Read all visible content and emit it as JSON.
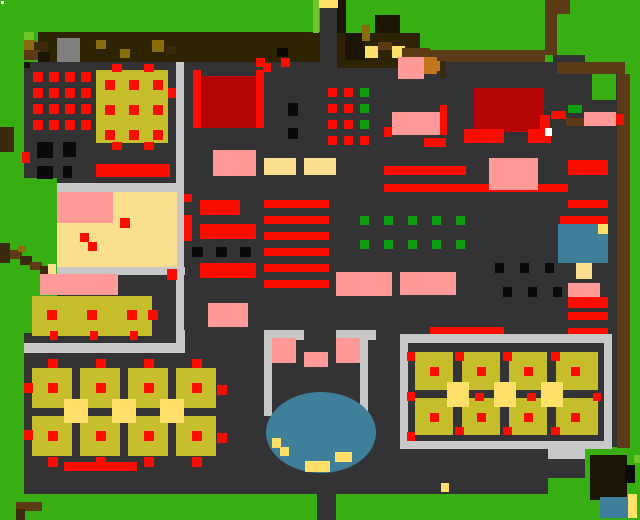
{
  "meta": {
    "view": "pixel-art-village-map",
    "description": "Top-down tile map: grass exterior, dark floor interior, tables, shelves, ponds",
    "width": 640,
    "height": 520
  },
  "palette": {
    "grass": "#37ae11",
    "grassLight": "#6fc32b",
    "floor": "#333336",
    "band": "#2e2302",
    "bandDark": "#1c1404",
    "brown": "#5c3a16",
    "brownDark": "#3c2a0e",
    "orange": "#c4761e",
    "darkYellow": "#8a6d0e",
    "olive": "#c6bd2b",
    "paleYellow": "#fbdf8e",
    "yellow": "#ffe069",
    "pink": "#ff9a98",
    "red": "#fb0d00",
    "darkRed": "#b40404",
    "green": "#0f9e10",
    "black": "#0a0a0a",
    "gray": "#c8c8c8",
    "grayMid": "#7f7f7f",
    "blue": "#3f7f9a",
    "white": "#ffffff"
  },
  "shapes": [
    [
      "r",
      24,
      62,
      593,
      432,
      "floor",
      "main-floor"
    ],
    [
      "r",
      0,
      178,
      57,
      155,
      "grass",
      "grass-notch-left"
    ],
    [
      "r",
      0,
      494,
      640,
      26,
      "grass",
      "grass-bottom"
    ],
    [
      "r",
      583,
      447,
      57,
      47,
      "grass",
      "grass-bottom-right"
    ],
    [
      "r",
      548,
      448,
      37,
      11,
      "gray",
      "wall-stub"
    ],
    [
      "r",
      548,
      459,
      37,
      19,
      "floor",
      "floor-stub"
    ],
    [
      "r",
      548,
      478,
      37,
      16,
      "grass",
      "grass-stub"
    ],
    [
      "r",
      1,
      1,
      3,
      3,
      "white",
      "map-dot"
    ],
    [
      "r",
      38,
      32,
      282,
      30,
      "band",
      "top-band-left"
    ],
    [
      "r",
      337,
      33,
      83,
      35,
      "band",
      "top-band-right"
    ],
    [
      "r",
      337,
      0,
      9,
      33,
      "bandDark",
      "gate-post"
    ],
    [
      "r",
      57,
      38,
      23,
      24,
      "grayMid",
      "band-gray-box"
    ],
    [
      "r",
      96,
      40,
      10,
      9,
      "darkYellow",
      "band-fleck"
    ],
    [
      "r",
      120,
      49,
      10,
      9,
      "darkYellow",
      "band-fleck"
    ],
    [
      "r",
      152,
      40,
      12,
      12,
      "darkYellow",
      "band-fleck"
    ],
    [
      "r",
      166,
      46,
      10,
      8,
      "brownDark",
      "band-fleck"
    ],
    [
      "r",
      277,
      48,
      11,
      9,
      "black",
      "band-fleck"
    ],
    [
      "r",
      345,
      33,
      20,
      27,
      "bandDark",
      "band-shadow"
    ],
    [
      "r",
      362,
      25,
      8,
      16,
      "darkYellow",
      "band-fleck"
    ],
    [
      "r",
      375,
      15,
      25,
      18,
      "bandDark",
      "tree-top"
    ],
    [
      "r",
      378,
      42,
      14,
      8,
      "brown",
      "band-post"
    ],
    [
      "r",
      365,
      46,
      13,
      12,
      "yellow",
      "lantern"
    ],
    [
      "r",
      392,
      46,
      13,
      12,
      "yellow",
      "lantern"
    ],
    [
      "r",
      402,
      48,
      28,
      10,
      "brown",
      "band-rail"
    ],
    [
      "r",
      256,
      58,
      9,
      9,
      "red",
      "gate-marker"
    ],
    [
      "r",
      281,
      58,
      9,
      9,
      "red",
      "gate-marker"
    ],
    [
      "r",
      24,
      32,
      10,
      10,
      "grassLight",
      "bush"
    ],
    [
      "r",
      24,
      40,
      12,
      10,
      "darkYellow",
      "bush"
    ],
    [
      "r",
      34,
      42,
      14,
      12,
      "brownDark",
      "bush"
    ],
    [
      "r",
      24,
      50,
      16,
      10,
      "brown",
      "bush"
    ],
    [
      "r",
      38,
      52,
      12,
      10,
      "bandDark",
      "bush"
    ],
    [
      "r",
      24,
      62,
      6,
      6,
      "bandDark",
      "bush"
    ],
    [
      "r",
      320,
      8,
      17,
      54,
      "floor",
      "north-path"
    ],
    [
      "r",
      318,
      0,
      20,
      8,
      "yellow",
      "north-gate"
    ],
    [
      "r",
      313,
      0,
      6,
      33,
      "grassLight",
      "grass-light-strip"
    ],
    [
      "r",
      420,
      50,
      125,
      12,
      "brown",
      "fence-top"
    ],
    [
      "r",
      420,
      57,
      17,
      17,
      "orange",
      "fence-block"
    ],
    [
      "r",
      545,
      0,
      25,
      14,
      "brown",
      "fence-v"
    ],
    [
      "r",
      545,
      14,
      12,
      41,
      "brown",
      "fence-v"
    ],
    [
      "r",
      553,
      55,
      32,
      43,
      "floor",
      "alcove"
    ],
    [
      "r",
      557,
      62,
      68,
      12,
      "brown",
      "fence-top-2"
    ],
    [
      "r",
      617,
      74,
      13,
      374,
      "brown",
      "right-strip"
    ],
    [
      "r",
      630,
      74,
      10,
      374,
      "grass",
      "grass-right-edge"
    ],
    [
      "r",
      592,
      74,
      24,
      26,
      "grass",
      "grass-pocket"
    ],
    [
      "r",
      473,
      88,
      71,
      44,
      "darkRed",
      "big-red-block"
    ],
    [
      "r",
      464,
      129,
      40,
      14,
      "red",
      "red-trim"
    ],
    [
      "r",
      528,
      129,
      23,
      14,
      "red",
      "red-trim"
    ],
    [
      "r",
      540,
      115,
      10,
      16,
      "red",
      "red-trim"
    ],
    [
      "r",
      440,
      105,
      7,
      30,
      "red",
      "red-trim"
    ],
    [
      "r",
      545,
      128,
      7,
      8,
      "white",
      "white-dot"
    ],
    [
      "r",
      568,
      105,
      14,
      8,
      "green",
      "green-chip"
    ],
    [
      "r",
      551,
      111,
      15,
      8,
      "red",
      "red-chip"
    ],
    [
      "r",
      566,
      118,
      18,
      8,
      "brown",
      "brown-chip"
    ],
    [
      "r",
      584,
      112,
      32,
      14,
      "pink",
      "pink-mat"
    ],
    [
      "r",
      616,
      114,
      8,
      11,
      "red",
      "red-dot"
    ],
    [
      "r",
      398,
      57,
      26,
      22,
      "pink",
      "pink-mat"
    ],
    [
      "r",
      424,
      61,
      16,
      10,
      "orange",
      "crate-orange"
    ],
    [
      "r",
      440,
      61,
      6,
      17,
      "brownDark",
      "crate-shadow"
    ],
    [
      "r",
      392,
      112,
      48,
      23,
      "pink",
      "pink-mat"
    ],
    [
      "r",
      384,
      127,
      8,
      10,
      "red",
      "red-dot"
    ],
    [
      "r",
      424,
      138,
      22,
      9,
      "red",
      "red-trim"
    ],
    [
      "r",
      384,
      166,
      82,
      9,
      "red",
      "shelf-bar"
    ],
    [
      "r",
      384,
      184,
      184,
      8,
      "red",
      "shelf-bar"
    ],
    [
      "r",
      489,
      158,
      49,
      32,
      "pink",
      "pink-mat"
    ],
    [
      "r",
      568,
      160,
      40,
      15,
      "red",
      "shelf-bar"
    ],
    [
      "r",
      568,
      200,
      40,
      8,
      "red",
      "shelf-bar"
    ],
    [
      "r",
      560,
      216,
      48,
      9,
      "red",
      "shelf-bar"
    ],
    [
      "r",
      558,
      224,
      50,
      39,
      "blue",
      "pool"
    ],
    [
      "r",
      598,
      224,
      10,
      10,
      "yellow",
      "pool-duck"
    ],
    [
      "r",
      576,
      263,
      16,
      16,
      "paleYellow",
      "pool-step"
    ],
    [
      "r",
      568,
      283,
      32,
      14,
      "pink",
      "pink-mat"
    ],
    [
      "r",
      568,
      297,
      40,
      11,
      "red",
      "shelf-bar"
    ],
    [
      "r",
      568,
      312,
      40,
      8,
      "red",
      "shelf-bar"
    ],
    [
      "r",
      568,
      328,
      40,
      9,
      "red",
      "shelf-bar"
    ],
    [
      "r",
      553,
      288,
      6,
      8,
      "black",
      "black-chip"
    ],
    [
      "g",
      33,
      72,
      16,
      16,
      4,
      4,
      10,
      10,
      "red",
      "stock-dot"
    ],
    [
      "r",
      96,
      70,
      72,
      73,
      "olive",
      "big-table"
    ],
    [
      "g",
      105,
      80,
      24,
      25,
      3,
      3,
      10,
      10,
      "red",
      "table-dot"
    ],
    [
      "r",
      112,
      64,
      10,
      8,
      "red",
      "table-dot"
    ],
    [
      "r",
      144,
      64,
      10,
      8,
      "red",
      "table-dot"
    ],
    [
      "r",
      112,
      142,
      10,
      8,
      "red",
      "table-dot"
    ],
    [
      "r",
      144,
      142,
      10,
      8,
      "red",
      "table-dot"
    ],
    [
      "r",
      168,
      88,
      10,
      10,
      "red",
      "table-dot"
    ],
    [
      "r",
      176,
      62,
      8,
      281,
      "gray",
      "wall-vertical"
    ],
    [
      "r",
      193,
      70,
      8,
      58,
      "red",
      "banner-post"
    ],
    [
      "r",
      256,
      70,
      8,
      58,
      "red",
      "banner-post"
    ],
    [
      "r",
      201,
      76,
      55,
      52,
      "darkRed",
      "red-banner"
    ],
    [
      "r",
      263,
      63,
      8,
      9,
      "red",
      "red-dot"
    ],
    [
      "r",
      288,
      103,
      10,
      13,
      "black",
      "black-post"
    ],
    [
      "r",
      288,
      128,
      10,
      11,
      "black",
      "black-post"
    ],
    [
      "g",
      328,
      88,
      16,
      16,
      2,
      4,
      9,
      9,
      "red",
      "stock-dot"
    ],
    [
      "g",
      360,
      88,
      0,
      16,
      1,
      3,
      9,
      9,
      "green",
      "stock-dot-green"
    ],
    [
      "r",
      360,
      136,
      9,
      9,
      "red",
      "stock-dot"
    ],
    [
      "r",
      37,
      142,
      16,
      16,
      "black",
      "crate"
    ],
    [
      "r",
      63,
      142,
      13,
      15,
      "black",
      "crate"
    ],
    [
      "r",
      37,
      166,
      16,
      13,
      "black",
      "crate"
    ],
    [
      "r",
      63,
      166,
      9,
      12,
      "black",
      "crate"
    ],
    [
      "r",
      22,
      152,
      8,
      11,
      "red",
      "red-dot"
    ],
    [
      "r",
      96,
      164,
      74,
      13,
      "red",
      "red-bar"
    ],
    [
      "r",
      0,
      127,
      14,
      25,
      "brownDark",
      "stump"
    ],
    [
      "r",
      213,
      150,
      43,
      26,
      "pink",
      "pink-mat"
    ],
    [
      "r",
      264,
      158,
      32,
      17,
      "paleYellow",
      "mat"
    ],
    [
      "r",
      304,
      158,
      32,
      17,
      "paleYellow",
      "mat"
    ],
    [
      "r",
      57,
      183,
      127,
      9,
      "gray",
      "room-wall-top"
    ],
    [
      "r",
      57,
      192,
      56,
      31,
      "pink",
      "room-rug"
    ],
    [
      "r",
      113,
      192,
      64,
      75,
      "paleYellow",
      "room-floor"
    ],
    [
      "r",
      57,
      223,
      56,
      44,
      "paleYellow",
      "room-floor"
    ],
    [
      "r",
      120,
      218,
      10,
      10,
      "red",
      "room-dot"
    ],
    [
      "r",
      80,
      233,
      9,
      9,
      "red",
      "room-dot"
    ],
    [
      "r",
      88,
      242,
      9,
      9,
      "red",
      "room-dot"
    ],
    [
      "r",
      57,
      267,
      128,
      8,
      "gray",
      "room-wall-bottom"
    ],
    [
      "r",
      167,
      269,
      10,
      11,
      "red",
      "door-marker"
    ],
    [
      "r",
      184,
      194,
      8,
      8,
      "red",
      "wall-dot"
    ],
    [
      "r",
      184,
      215,
      8,
      26,
      "red",
      "wall-banner"
    ],
    [
      "g",
      264,
      200,
      0,
      16,
      1,
      6,
      65,
      8,
      "red",
      "shelf-stripe"
    ],
    [
      "r",
      200,
      200,
      40,
      15,
      "red",
      "counter-bar"
    ],
    [
      "r",
      200,
      224,
      56,
      15,
      "red",
      "counter-bar"
    ],
    [
      "r",
      200,
      263,
      56,
      15,
      "red",
      "counter-bar"
    ],
    [
      "g",
      192,
      247,
      24,
      0,
      3,
      1,
      11,
      10,
      "black",
      "black-dot"
    ],
    [
      "g",
      360,
      216,
      24,
      24,
      5,
      2,
      9,
      9,
      "green",
      "plant-dot"
    ],
    [
      "r",
      336,
      272,
      56,
      24,
      "pink",
      "pink-mat"
    ],
    [
      "r",
      400,
      272,
      56,
      23,
      "pink",
      "pink-mat"
    ],
    [
      "r",
      208,
      303,
      40,
      24,
      "pink",
      "pink-mat"
    ],
    [
      "r",
      0,
      243,
      10,
      20,
      "brownDark",
      "log"
    ],
    [
      "r",
      10,
      250,
      12,
      9,
      "brown",
      "log"
    ],
    [
      "r",
      20,
      256,
      12,
      9,
      "brownDark",
      "log"
    ],
    [
      "r",
      30,
      262,
      12,
      8,
      "brown",
      "log"
    ],
    [
      "r",
      40,
      266,
      10,
      8,
      "brownDark",
      "log"
    ],
    [
      "r",
      18,
      246,
      8,
      6,
      "darkYellow",
      "log-moss"
    ],
    [
      "r",
      48,
      264,
      8,
      10,
      "paleYellow",
      "log-end"
    ],
    [
      "r",
      40,
      274,
      78,
      21,
      "pink",
      "pink-bench"
    ],
    [
      "r",
      32,
      296,
      120,
      40,
      "olive",
      "long-table"
    ],
    [
      "g",
      47,
      310,
      40,
      0,
      3,
      1,
      10,
      10,
      "red",
      "table-dot"
    ],
    [
      "r",
      148,
      310,
      10,
      10,
      "red",
      "table-dot"
    ],
    [
      "g",
      50,
      331,
      40,
      0,
      3,
      1,
      8,
      9,
      "red",
      "table-dot"
    ],
    [
      "r",
      24,
      343,
      161,
      10,
      "gray",
      "wall-horizontal"
    ],
    [
      "r",
      177,
      330,
      8,
      13,
      "gray",
      "wall-corner"
    ],
    [
      "g",
      32,
      368,
      48,
      48,
      4,
      2,
      40,
      40,
      "olive",
      "dining-table"
    ],
    [
      "g",
      64,
      399,
      48,
      0,
      3,
      1,
      24,
      24,
      "yellow",
      "chair"
    ],
    [
      "g",
      48,
      383,
      48,
      48,
      4,
      2,
      10,
      10,
      "red",
      "table-dot"
    ],
    [
      "g",
      48,
      359,
      48,
      0,
      4,
      1,
      10,
      9,
      "red",
      "table-dot"
    ],
    [
      "g",
      48,
      457,
      48,
      0,
      4,
      1,
      10,
      10,
      "red",
      "table-dot"
    ],
    [
      "r",
      24,
      383,
      9,
      10,
      "red",
      "table-dot"
    ],
    [
      "r",
      24,
      430,
      9,
      10,
      "red",
      "table-dot"
    ],
    [
      "r",
      217,
      385,
      10,
      10,
      "red",
      "table-dot"
    ],
    [
      "r",
      217,
      433,
      10,
      10,
      "red",
      "table-dot"
    ],
    [
      "r",
      64,
      462,
      73,
      9,
      "red",
      "red-bar"
    ],
    [
      "r",
      16,
      502,
      26,
      9,
      "brown",
      "sign"
    ],
    [
      "r",
      16,
      509,
      9,
      11,
      "brownDark",
      "sign-post"
    ],
    [
      "r",
      264,
      330,
      40,
      10,
      "gray",
      "pond-wall"
    ],
    [
      "r",
      336,
      330,
      40,
      10,
      "gray",
      "pond-wall"
    ],
    [
      "r",
      264,
      340,
      8,
      76,
      "gray",
      "pond-wall"
    ],
    [
      "r",
      360,
      340,
      8,
      76,
      "gray",
      "pond-wall"
    ],
    [
      "r",
      272,
      338,
      24,
      25,
      "pink",
      "pond-mat"
    ],
    [
      "r",
      336,
      338,
      24,
      25,
      "pink",
      "pond-mat"
    ],
    [
      "r",
      304,
      352,
      24,
      15,
      "pink",
      "pond-mat"
    ],
    [
      "e",
      266,
      392,
      110,
      81,
      "blue",
      "pond"
    ],
    [
      "r",
      272,
      438,
      9,
      10,
      "yellow",
      "pond-duck"
    ],
    [
      "r",
      280,
      447,
      9,
      9,
      "yellow",
      "pond-duck"
    ],
    [
      "r",
      305,
      461,
      25,
      11,
      "yellow",
      "pond-duck"
    ],
    [
      "r",
      335,
      452,
      17,
      10,
      "yellow",
      "pond-duck"
    ],
    [
      "r",
      317,
      494,
      19,
      26,
      "floor",
      "south-path"
    ],
    [
      "r",
      430,
      327,
      74,
      10,
      "red",
      "red-bar"
    ],
    [
      "r",
      400,
      334,
      212,
      9,
      "gray",
      "hall-wall-top"
    ],
    [
      "r",
      400,
      334,
      8,
      115,
      "gray",
      "hall-wall-left"
    ],
    [
      "r",
      604,
      334,
      8,
      115,
      "gray",
      "hall-wall-right"
    ],
    [
      "r",
      400,
      441,
      212,
      8,
      "gray",
      "hall-wall-bottom"
    ],
    [
      "r",
      408,
      343,
      196,
      98,
      "floor",
      "hall-floor"
    ],
    [
      "r",
      415,
      352,
      183,
      83,
      "olive",
      "hall-table"
    ],
    [
      "g",
      453,
      352,
      47,
      0,
      3,
      1,
      9,
      83,
      "floor",
      "hall-divider"
    ],
    [
      "r",
      415,
      390,
      183,
      8,
      "floor",
      "hall-divider-h"
    ],
    [
      "g",
      447,
      382,
      47,
      0,
      3,
      1,
      22,
      25,
      "yellow",
      "chair"
    ],
    [
      "g",
      430,
      367,
      47,
      46,
      4,
      2,
      9,
      9,
      "red",
      "table-dot"
    ],
    [
      "g",
      455,
      352,
      48,
      0,
      3,
      1,
      9,
      9,
      "red",
      "table-dot"
    ],
    [
      "g",
      455,
      427,
      48,
      0,
      3,
      1,
      9,
      8,
      "red",
      "table-dot"
    ],
    [
      "g",
      475,
      393,
      52,
      0,
      2,
      1,
      9,
      8,
      "red",
      "table-dot"
    ],
    [
      "r",
      593,
      393,
      8,
      8,
      "red",
      "table-dot"
    ],
    [
      "g",
      407,
      352,
      0,
      40,
      1,
      3,
      8,
      9,
      "red",
      "table-dot"
    ],
    [
      "r",
      441,
      483,
      8,
      9,
      "yellow",
      "dropped-item"
    ],
    [
      "g",
      495,
      263,
      25,
      0,
      3,
      1,
      9,
      10,
      "black",
      "black-dot"
    ],
    [
      "g",
      503,
      287,
      25,
      0,
      3,
      1,
      9,
      10,
      "black",
      "black-dot"
    ],
    [
      "r",
      590,
      455,
      37,
      45,
      "bandDark",
      "tree-canopy"
    ],
    [
      "r",
      625,
      465,
      10,
      18,
      "black",
      "tree-shadow"
    ],
    [
      "r",
      634,
      455,
      6,
      8,
      "grassLight",
      "leaf"
    ],
    [
      "r",
      600,
      497,
      28,
      21,
      "blue",
      "water"
    ],
    [
      "r",
      628,
      494,
      9,
      24,
      "yellow",
      "water-edge"
    ]
  ]
}
